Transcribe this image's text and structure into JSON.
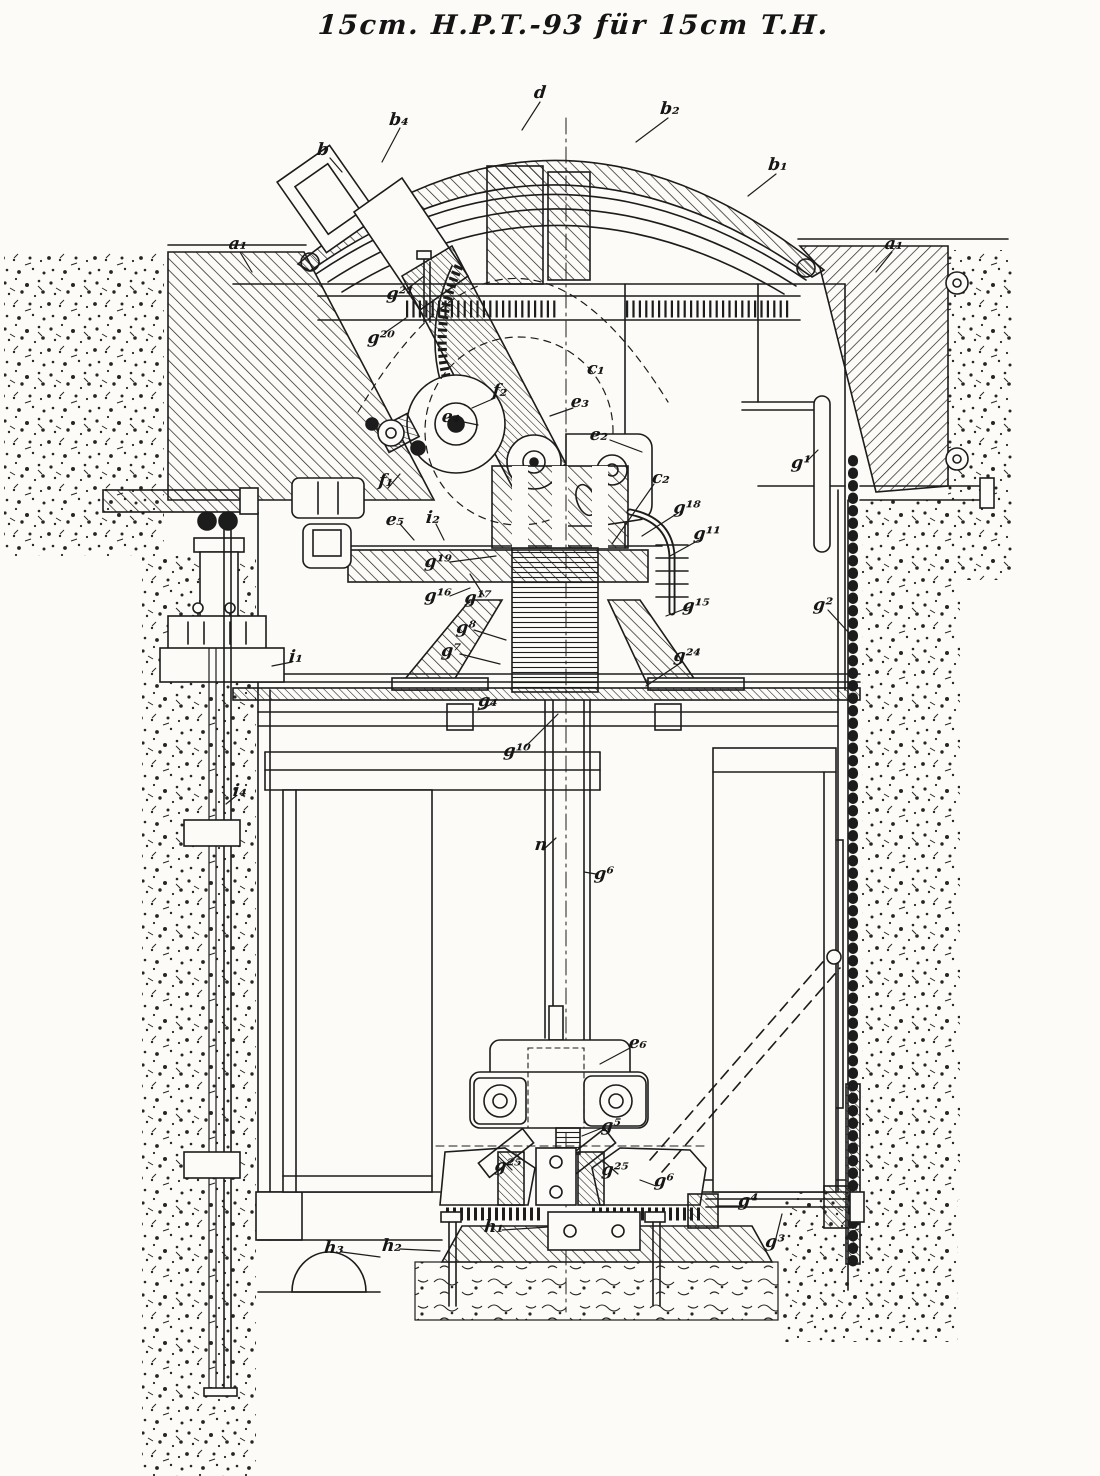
{
  "meta": {
    "drawing_type": "sectional-elevation",
    "ink_color": "#1c1c1c",
    "paper_color": "#fcfbf7"
  },
  "title": {
    "text": "15cm. H.P.T.-93 für 15cm T.H."
  },
  "labels": [
    {
      "id": "d",
      "text": "d",
      "x": 540,
      "y": 94
    },
    {
      "id": "b4",
      "text": "b₄",
      "x": 399,
      "y": 121
    },
    {
      "id": "b2",
      "text": "b₂",
      "x": 670,
      "y": 110
    },
    {
      "id": "b",
      "text": "b",
      "x": 323,
      "y": 151
    },
    {
      "id": "b1",
      "text": "b₁",
      "x": 778,
      "y": 166
    },
    {
      "id": "a1-left",
      "text": "a₁",
      "x": 238,
      "y": 245
    },
    {
      "id": "a1-right",
      "text": "a₁",
      "x": 894,
      "y": 245
    },
    {
      "id": "g21",
      "text": "g²¹",
      "x": 400,
      "y": 295
    },
    {
      "id": "g20",
      "text": "g²⁰",
      "x": 381,
      "y": 339
    },
    {
      "id": "c1",
      "text": "c₁",
      "x": 596,
      "y": 370
    },
    {
      "id": "f2",
      "text": "f₂",
      "x": 500,
      "y": 392
    },
    {
      "id": "e3",
      "text": "e₃",
      "x": 580,
      "y": 403
    },
    {
      "id": "e4",
      "text": "e₄",
      "x": 451,
      "y": 418
    },
    {
      "id": "e2",
      "text": "e₂",
      "x": 599,
      "y": 436
    },
    {
      "id": "c2",
      "text": "c₂",
      "x": 661,
      "y": 479
    },
    {
      "id": "f1",
      "text": "f₁",
      "x": 386,
      "y": 482
    },
    {
      "id": "e5",
      "text": "e₅",
      "x": 395,
      "y": 521
    },
    {
      "id": "i2",
      "text": "i₂",
      "x": 433,
      "y": 519
    },
    {
      "id": "g18",
      "text": "g¹⁸",
      "x": 687,
      "y": 509
    },
    {
      "id": "g11",
      "text": "g¹¹",
      "x": 707,
      "y": 535
    },
    {
      "id": "g19",
      "text": "g¹⁹",
      "x": 438,
      "y": 563
    },
    {
      "id": "g16",
      "text": "g¹⁶",
      "x": 438,
      "y": 597
    },
    {
      "id": "g17",
      "text": "g¹⁷",
      "x": 478,
      "y": 599
    },
    {
      "id": "g15",
      "text": "g¹⁵",
      "x": 696,
      "y": 607
    },
    {
      "id": "g1",
      "text": "g¹",
      "x": 801,
      "y": 464
    },
    {
      "id": "g2",
      "text": "g²",
      "x": 823,
      "y": 606
    },
    {
      "id": "g8",
      "text": "g⁸",
      "x": 466,
      "y": 629
    },
    {
      "id": "g7",
      "text": "g⁷",
      "x": 451,
      "y": 652
    },
    {
      "id": "g24",
      "text": "g²⁴",
      "x": 687,
      "y": 657
    },
    {
      "id": "i1",
      "text": "i₁",
      "x": 296,
      "y": 658
    },
    {
      "id": "g4-hub",
      "text": "g₄",
      "x": 488,
      "y": 702
    },
    {
      "id": "g10",
      "text": "g¹⁰",
      "x": 517,
      "y": 752
    },
    {
      "id": "i4",
      "text": "i₄",
      "x": 240,
      "y": 792
    },
    {
      "id": "n",
      "text": "n",
      "x": 541,
      "y": 846
    },
    {
      "id": "g6-rod",
      "text": "g⁶",
      "x": 604,
      "y": 875
    },
    {
      "id": "e6",
      "text": "e₆",
      "x": 638,
      "y": 1044
    },
    {
      "id": "g5",
      "text": "g⁵",
      "x": 611,
      "y": 1127
    },
    {
      "id": "g25-left",
      "text": "g²⁵",
      "x": 508,
      "y": 1167
    },
    {
      "id": "g25-right",
      "text": "g²⁵",
      "x": 615,
      "y": 1171
    },
    {
      "id": "g6-base",
      "text": "g⁶",
      "x": 664,
      "y": 1182
    },
    {
      "id": "g4-shaft",
      "text": "g⁴",
      "x": 748,
      "y": 1202
    },
    {
      "id": "h1",
      "text": "h₁",
      "x": 494,
      "y": 1228
    },
    {
      "id": "g3",
      "text": "g³",
      "x": 775,
      "y": 1243
    },
    {
      "id": "h2",
      "text": "h₂",
      "x": 392,
      "y": 1247
    },
    {
      "id": "h3",
      "text": "h₃",
      "x": 334,
      "y": 1249
    }
  ]
}
